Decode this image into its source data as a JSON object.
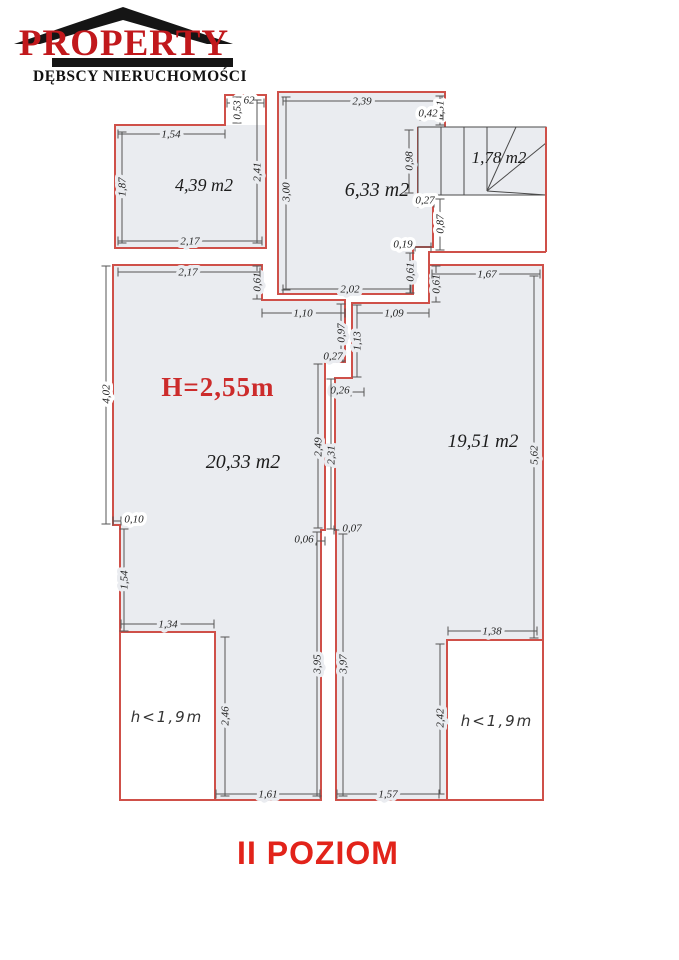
{
  "logo": {
    "brand": "PROPERTY",
    "subtitle": "DĘBSCY NIERUCHOMOŚCI",
    "brand_color": "#c1181c"
  },
  "title": {
    "text": "II POZIOM",
    "color": "#e2231a"
  },
  "colors": {
    "wall": "#cf5049",
    "room_fill": "#eaecf0",
    "plan_line": "#4a4a4a",
    "dim_line": "#555555",
    "dim_text": "#222222",
    "white": "#ffffff"
  },
  "plan": {
    "height_note": {
      "text": "H=2,55m"
    },
    "rooms": [
      {
        "name": "room-4-39",
        "outline": "115,125 225,125 225,95 266,95 266,248 115,248",
        "fill": "115,125 266,125 266,248 115,248",
        "label": {
          "t": "4,39 m2",
          "x": 204,
          "y": 191,
          "s": 18
        }
      },
      {
        "name": "room-6-33",
        "outline": "278,92 445,92 445,128 418,128 418,197 433,197 433,247 413,247 413,294 278,294",
        "label": {
          "t": "6,33 m2",
          "x": 377,
          "y": 196,
          "s": 20
        }
      },
      {
        "name": "room-20-33",
        "outline": "113,265 262,265 262,300 345,300 345,362 325,362 325,530 321,530 321,800 120,800 120,525 113,525",
        "label": {
          "t": "20,33 m2",
          "x": 243,
          "y": 468,
          "s": 20
        }
      },
      {
        "name": "room-19-51",
        "outline": "429,265 543,265 543,800 336,800 336,530 335,530 335,378 352,378 352,303 429,303",
        "label": {
          "t": "19,51 m2",
          "x": 483,
          "y": 447,
          "s": 19
        }
      }
    ],
    "stairs": {
      "x": 418,
      "y": 127,
      "w": 128,
      "h": 68,
      "lines": [
        [
          441,
          127,
          441,
          195
        ],
        [
          464,
          127,
          464,
          195
        ],
        [
          487,
          127,
          487,
          191
        ],
        [
          487,
          191,
          516,
          127
        ],
        [
          487,
          191,
          546,
          143
        ],
        [
          487,
          191,
          546,
          195
        ]
      ],
      "label": {
        "t": "1,78 m2",
        "x": 499,
        "y": 163,
        "s": 17
      }
    },
    "extra_walls": [
      [
        546,
        127,
        546,
        252
      ],
      [
        428,
        252,
        546,
        252
      ],
      [
        429,
        252,
        429,
        265
      ]
    ],
    "low_areas": [
      {
        "x": 120,
        "y": 632,
        "w": 95,
        "h": 168,
        "label": {
          "t": "h<1,9m",
          "x": 167,
          "y": 722
        }
      },
      {
        "x": 447,
        "y": 640,
        "w": 96,
        "h": 160,
        "label": {
          "t": "h<1,9m",
          "x": 497,
          "y": 726
        }
      }
    ],
    "dimensions": [
      {
        "t": "1,54",
        "x1": 118,
        "y1": 134,
        "x2": 225,
        "y2": 134,
        "lx": 171,
        "ly": 134,
        "r": 0,
        "bg": "g"
      },
      {
        "t": "0,62",
        "x1": 227,
        "y1": 103,
        "x2": 264,
        "y2": 103,
        "lx": 245,
        "ly": 100,
        "r": 0,
        "bg": "w"
      },
      {
        "t": "0,53",
        "x1": 237,
        "y1": 97,
        "x2": 237,
        "y2": 123,
        "lx": 237,
        "ly": 110,
        "r": 1,
        "bg": "w"
      },
      {
        "t": "1,87",
        "x1": 122,
        "y1": 132,
        "x2": 122,
        "y2": 243,
        "lx": 122,
        "ly": 187,
        "r": 1,
        "bg": "g"
      },
      {
        "t": "2,41",
        "x1": 257,
        "y1": 100,
        "x2": 257,
        "y2": 243,
        "lx": 257,
        "ly": 172,
        "r": 1,
        "bg": "g"
      },
      {
        "t": "2,17",
        "x1": 118,
        "y1": 241,
        "x2": 262,
        "y2": 241,
        "lx": 190,
        "ly": 241,
        "r": 0,
        "bg": "g"
      },
      {
        "t": "2,39",
        "x1": 283,
        "y1": 101,
        "x2": 442,
        "y2": 101,
        "lx": 362,
        "ly": 101,
        "r": 0,
        "bg": "g"
      },
      {
        "t": "3,00",
        "x1": 286,
        "y1": 97,
        "x2": 286,
        "y2": 290,
        "lx": 286,
        "ly": 192,
        "r": 1,
        "bg": "g"
      },
      {
        "t": "0,51",
        "x1": 440,
        "y1": 96,
        "x2": 440,
        "y2": 125,
        "lx": 440,
        "ly": 110,
        "r": 1,
        "bg": "w"
      },
      {
        "t": "0,42",
        "x1": 420,
        "y1": 116,
        "x2": 443,
        "y2": 116,
        "lx": 428,
        "ly": 113,
        "r": 0,
        "bg": "w"
      },
      {
        "t": "0,98",
        "x1": 409,
        "y1": 130,
        "x2": 409,
        "y2": 193,
        "lx": 409,
        "ly": 161,
        "r": 1,
        "bg": "g"
      },
      {
        "t": "0,27",
        "x1": 418,
        "y1": 203,
        "x2": 434,
        "y2": 203,
        "lx": 425,
        "ly": 200,
        "r": 0,
        "bg": "w"
      },
      {
        "t": "0,87",
        "x1": 440,
        "y1": 199,
        "x2": 440,
        "y2": 250,
        "lx": 440,
        "ly": 224,
        "r": 1,
        "bg": "w"
      },
      {
        "t": "0,19",
        "x1": 415,
        "y1": 247,
        "x2": 431,
        "y2": 247,
        "lx": 403,
        "ly": 244,
        "r": 0,
        "bg": "w"
      },
      {
        "t": "2,02",
        "x1": 283,
        "y1": 289,
        "x2": 411,
        "y2": 289,
        "lx": 350,
        "ly": 289,
        "r": 0,
        "bg": "g"
      },
      {
        "t": "0,61",
        "x1": 257,
        "y1": 266,
        "x2": 257,
        "y2": 299,
        "lx": 257,
        "ly": 282,
        "r": 1,
        "bg": "g"
      },
      {
        "t": "0,61",
        "x1": 410,
        "y1": 253,
        "x2": 410,
        "y2": 293,
        "lx": 410,
        "ly": 272,
        "r": 1,
        "bg": "g"
      },
      {
        "t": "0,61",
        "x1": 436,
        "y1": 266,
        "x2": 436,
        "y2": 302,
        "lx": 436,
        "ly": 284,
        "r": 1,
        "bg": "g"
      },
      {
        "t": "1,10",
        "x1": 262,
        "y1": 313,
        "x2": 345,
        "y2": 313,
        "lx": 303,
        "ly": 313,
        "r": 0,
        "bg": "g"
      },
      {
        "t": "1,09",
        "x1": 357,
        "y1": 313,
        "x2": 429,
        "y2": 313,
        "lx": 394,
        "ly": 313,
        "r": 0,
        "bg": "g"
      },
      {
        "t": "0,97",
        "x1": 341,
        "y1": 304,
        "x2": 341,
        "y2": 361,
        "lx": 341,
        "ly": 333,
        "r": 1,
        "bg": "g"
      },
      {
        "t": "1,13",
        "x1": 357,
        "y1": 305,
        "x2": 357,
        "y2": 377,
        "lx": 357,
        "ly": 341,
        "r": 1,
        "bg": "g"
      },
      {
        "t": "0,27",
        "x1": 325,
        "y1": 358,
        "x2": 343,
        "y2": 358,
        "lx": 333,
        "ly": 356,
        "r": 0,
        "bg": "g"
      },
      {
        "t": "0,26",
        "x1": 351,
        "y1": 392,
        "x2": 364,
        "y2": 392,
        "lx": 340,
        "ly": 390,
        "r": 0,
        "bg": "g"
      },
      {
        "t": "2,49",
        "x1": 318,
        "y1": 364,
        "x2": 318,
        "y2": 528,
        "lx": 318,
        "ly": 447,
        "r": 1,
        "bg": "g"
      },
      {
        "t": "2,31",
        "x1": 331,
        "y1": 379,
        "x2": 331,
        "y2": 529,
        "lx": 331,
        "ly": 455,
        "r": 1,
        "bg": "g"
      },
      {
        "t": "0,06",
        "x1": 316,
        "y1": 541,
        "x2": 325,
        "y2": 541,
        "lx": 304,
        "ly": 539,
        "r": 0,
        "bg": "g"
      },
      {
        "t": "0,07",
        "x1": 334,
        "y1": 530,
        "x2": 343,
        "y2": 530,
        "lx": 352,
        "ly": 528,
        "r": 0,
        "bg": "g"
      },
      {
        "t": "2,17",
        "x1": 118,
        "y1": 272,
        "x2": 260,
        "y2": 272,
        "lx": 188,
        "ly": 272,
        "r": 0,
        "bg": "g"
      },
      {
        "t": "4,02",
        "x1": 106,
        "y1": 266,
        "x2": 106,
        "y2": 524,
        "lx": 106,
        "ly": 394,
        "r": 1,
        "bg": "w"
      },
      {
        "t": "0,10",
        "x1": 113,
        "y1": 521,
        "x2": 121,
        "y2": 521,
        "lx": 134,
        "ly": 519,
        "r": 0,
        "bg": "w"
      },
      {
        "t": "1,54",
        "x1": 124,
        "y1": 529,
        "x2": 124,
        "y2": 631,
        "lx": 124,
        "ly": 580,
        "r": 1,
        "bg": "g"
      },
      {
        "t": "1,34",
        "x1": 121,
        "y1": 624,
        "x2": 214,
        "y2": 624,
        "lx": 168,
        "ly": 624,
        "r": 0,
        "bg": "g"
      },
      {
        "t": "2,46",
        "x1": 225,
        "y1": 637,
        "x2": 225,
        "y2": 796,
        "lx": 225,
        "ly": 716,
        "r": 1,
        "bg": "g"
      },
      {
        "t": "1,61",
        "x1": 216,
        "y1": 794,
        "x2": 320,
        "y2": 794,
        "lx": 268,
        "ly": 794,
        "r": 0,
        "bg": "g"
      },
      {
        "t": "3,95",
        "x1": 317,
        "y1": 532,
        "x2": 317,
        "y2": 796,
        "lx": 317,
        "ly": 664,
        "r": 1,
        "bg": "g"
      },
      {
        "t": "1,67",
        "x1": 432,
        "y1": 274,
        "x2": 540,
        "y2": 274,
        "lx": 487,
        "ly": 274,
        "r": 0,
        "bg": "g"
      },
      {
        "t": "5,62",
        "x1": 534,
        "y1": 276,
        "x2": 534,
        "y2": 638,
        "lx": 534,
        "ly": 455,
        "r": 1,
        "bg": "g"
      },
      {
        "t": "1,38",
        "x1": 448,
        "y1": 631,
        "x2": 537,
        "y2": 631,
        "lx": 492,
        "ly": 631,
        "r": 0,
        "bg": "g"
      },
      {
        "t": "2,42",
        "x1": 440,
        "y1": 644,
        "x2": 440,
        "y2": 794,
        "lx": 440,
        "ly": 718,
        "r": 1,
        "bg": "g"
      },
      {
        "t": "1,57",
        "x1": 337,
        "y1": 794,
        "x2": 439,
        "y2": 794,
        "lx": 388,
        "ly": 794,
        "r": 0,
        "bg": "g"
      },
      {
        "t": "3,97",
        "x1": 343,
        "y1": 534,
        "x2": 343,
        "y2": 796,
        "lx": 343,
        "ly": 664,
        "r": 1,
        "bg": "g"
      }
    ]
  }
}
